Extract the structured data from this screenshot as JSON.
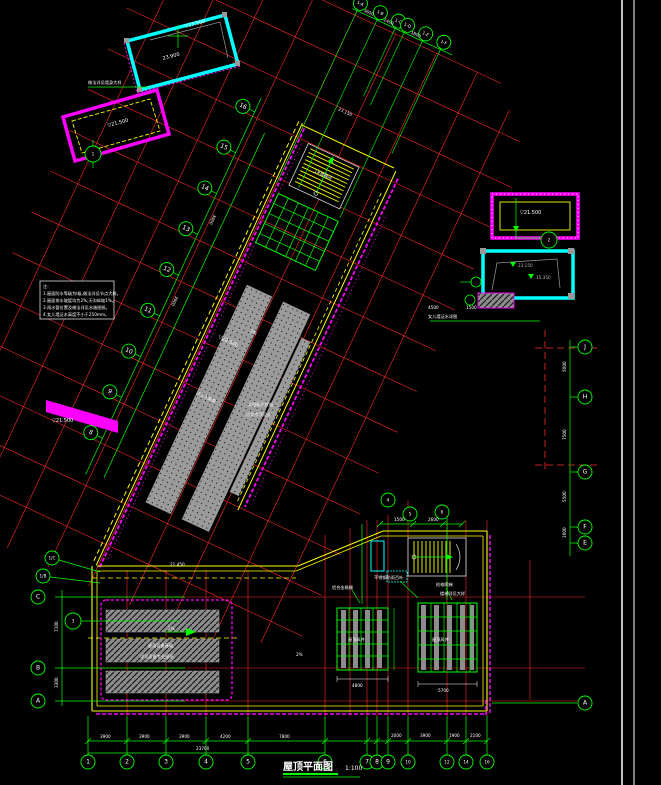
{
  "drawing_title": {
    "text": "屋顶平面图",
    "scale": "1:100"
  },
  "notes": {
    "lines": [
      "注:",
      "1.屋面防水等级为Ⅰ级,做法详见节点大样。",
      "2.屋面排水坡度均为2%,天沟纵坡1%。",
      "3.雨水管位置及做法详见水施图纸。",
      "4.女儿墙泛水高度不小于250mm。"
    ]
  },
  "axis_bubbles": {
    "bottom": [
      "1",
      "2",
      "3",
      "4",
      "5",
      "6",
      "7",
      "8",
      "9",
      "10",
      "12",
      "14",
      "16"
    ],
    "left": [
      "1/C",
      "1/B",
      "C",
      "B",
      "A"
    ],
    "right": [
      "J",
      "H",
      "G",
      "F",
      "E",
      "A"
    ],
    "top": [
      "1-A",
      "1-B",
      "1-C",
      "1-D",
      "1-E",
      "1-F"
    ],
    "wing": [
      "16",
      "15",
      "14",
      "13",
      "12",
      "11",
      "10",
      "9",
      "8"
    ]
  },
  "detail_marks": [
    "1",
    "2",
    "3",
    "4",
    "5",
    "6"
  ],
  "dimensions": {
    "bottom": [
      "3900",
      "3900",
      "3900",
      "4200",
      "7800"
    ],
    "bottom_total": "23700",
    "bottom_right": [
      "2000",
      "3900",
      "1900",
      "2100"
    ],
    "left": [
      "7100",
      "3300"
    ],
    "right": [
      "5000",
      "7500",
      "5500",
      "1600"
    ],
    "top": [
      "3600",
      "2400",
      "1800"
    ],
    "wing": [
      "3900",
      "3900"
    ],
    "grid_left_total": "4800",
    "grid_right_total": "5700",
    "stair": [
      "1500",
      "2600"
    ]
  },
  "annotations": [
    {
      "text": "▽23.500"
    },
    {
      "text": "23.900"
    },
    {
      "text": "做法详见墙身大样"
    },
    {
      "text": "▽21.500"
    },
    {
      "text": "▽21.500"
    },
    {
      "text": "23.150"
    },
    {
      "text": "15.350"
    },
    {
      "text": "▽22.500"
    },
    {
      "text": "不上人屋面"
    },
    {
      "text": "太阳能光伏板"
    },
    {
      "text": "详见专项设计"
    },
    {
      "text": "屋面设备基础"
    },
    {
      "text": "详见设备专业图纸"
    },
    {
      "text": "屋顶风井"
    },
    {
      "text": "屋顶风井"
    },
    {
      "text": "不锈钢防雨百叶"
    },
    {
      "text": "铝合金格栅"
    },
    {
      "text": "检修爬梯"
    },
    {
      "text": "楼梯详见大样"
    },
    {
      "text": "1#楼梯间"
    },
    {
      "text": "23.150"
    },
    {
      "text": "▽21.500"
    },
    {
      "text": "女儿墙泛水详图"
    },
    {
      "text": "2%"
    },
    {
      "text": "2%"
    },
    {
      "text": "2%"
    },
    {
      "text": "21.450"
    },
    {
      "text": "4500"
    },
    {
      "text": "1500"
    }
  ],
  "colors": {
    "background": "#000000",
    "axis_red": "#ff2a2a",
    "dim_green": "#00ff00",
    "boundary_yellow": "#ffff00",
    "detail_magenta": "#ff00ff",
    "detail_cyan": "#00ffff",
    "hatch_gray": "#8c8c8c",
    "text_white": "#ffffff"
  }
}
